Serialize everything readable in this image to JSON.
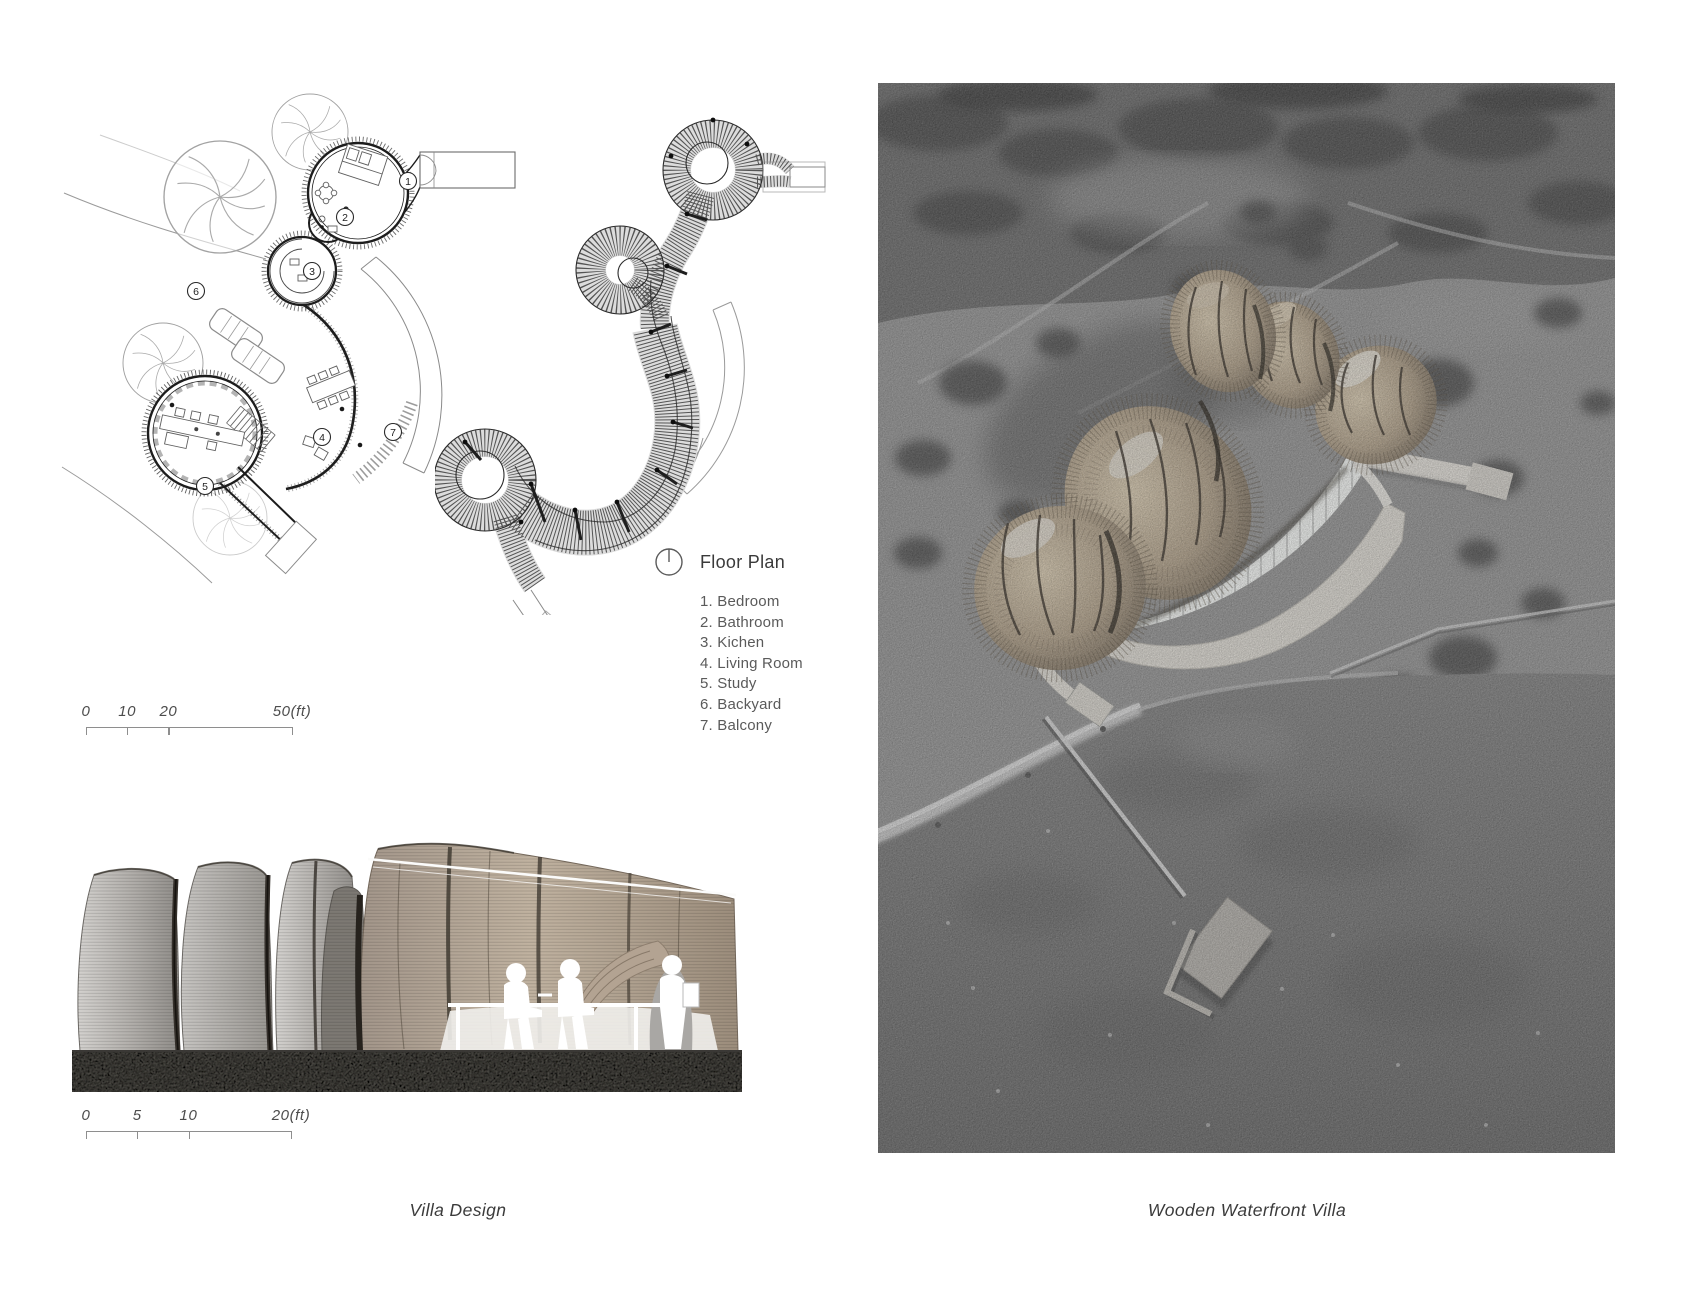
{
  "sheet": {
    "background": "#ffffff"
  },
  "legend": {
    "icon": "north-indicator-icon",
    "title": "Floor Plan",
    "items": [
      {
        "num": "1.",
        "label": "Bedroom"
      },
      {
        "num": "2.",
        "label": "Bathroom"
      },
      {
        "num": "3.",
        "label": "Kichen"
      },
      {
        "num": "4.",
        "label": "Living Room"
      },
      {
        "num": "5.",
        "label": "Study"
      },
      {
        "num": "6.",
        "label": "Backyard"
      },
      {
        "num": "7.",
        "label": "Balcony"
      }
    ]
  },
  "plan_markers": [
    {
      "num": "1",
      "x": 348,
      "y": 106
    },
    {
      "num": "2",
      "x": 285,
      "y": 142
    },
    {
      "num": "3",
      "x": 252,
      "y": 196
    },
    {
      "num": "4",
      "x": 262,
      "y": 362
    },
    {
      "num": "5",
      "x": 145,
      "y": 411
    },
    {
      "num": "6",
      "x": 136,
      "y": 216
    },
    {
      "num": "7",
      "x": 333,
      "y": 357
    }
  ],
  "scalebars": [
    {
      "name": "plan-scale",
      "max": 50,
      "ticks": [
        {
          "value": 0,
          "label": "0"
        },
        {
          "value": 10,
          "label": "10"
        },
        {
          "value": 20,
          "label": "20"
        },
        {
          "value": 50,
          "label": "50(ft)"
        }
      ]
    },
    {
      "name": "section-scale",
      "max": 20,
      "ticks": [
        {
          "value": 0,
          "label": "0"
        },
        {
          "value": 5,
          "label": "5"
        },
        {
          "value": 10,
          "label": "10"
        },
        {
          "value": 20,
          "label": "20(ft)"
        }
      ]
    }
  ],
  "captions": {
    "left": "Villa Design",
    "right": "Wooden Waterfront Villa"
  },
  "colors": {
    "ink": "#1c1c1c",
    "line_gray": "#8e8e8e",
    "text_gray": "#5a5a5a",
    "caption": "#3b3b3b",
    "wood_light": "#c7b9a2",
    "wood_dark": "#473e32",
    "terrace_white": "#eceae5",
    "photo_field": "#8f8f8f",
    "photo_forest": "#676767",
    "photo_water": "#717171",
    "ground_dark": "#55524d"
  }
}
